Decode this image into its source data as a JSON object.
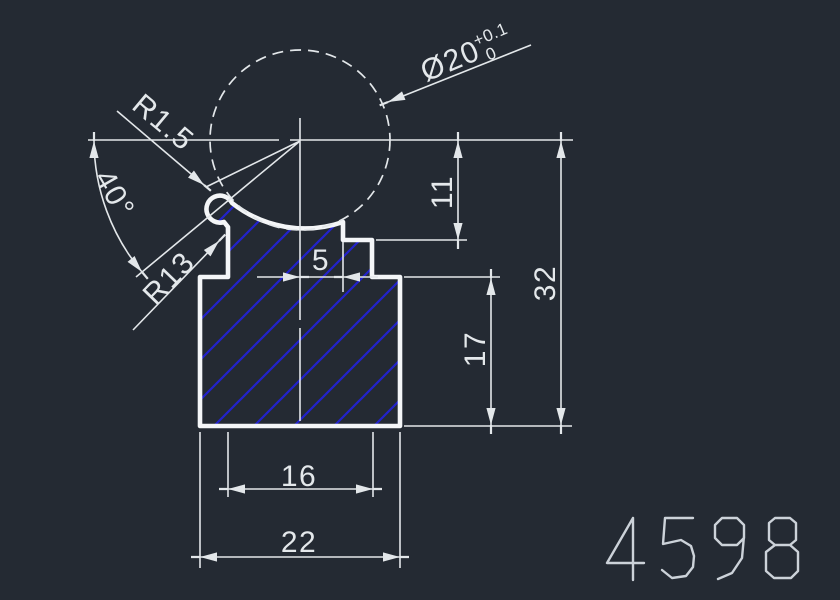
{
  "drawing": {
    "type": "cad-section-view",
    "units": "mm",
    "dimensions": {
      "diameter_value": "Ø20",
      "diameter_tol_upper": "+0.1",
      "diameter_tol_lower": "0",
      "radius_small": "R1.5",
      "angle": "40°",
      "radius_socket": "R13",
      "offset_center_to_step": "5",
      "step_depth": "11",
      "total_height": "32",
      "body_height": "17",
      "boss_width": "16",
      "body_width": "22"
    },
    "drawing_number": "4598",
    "colors": {
      "background": "#242a33",
      "line": "#e3e7ea",
      "outline": "#f4f6f8",
      "hatch": "#2222cc",
      "text": "#e4e8eb",
      "number": "#ccd2d9"
    }
  }
}
